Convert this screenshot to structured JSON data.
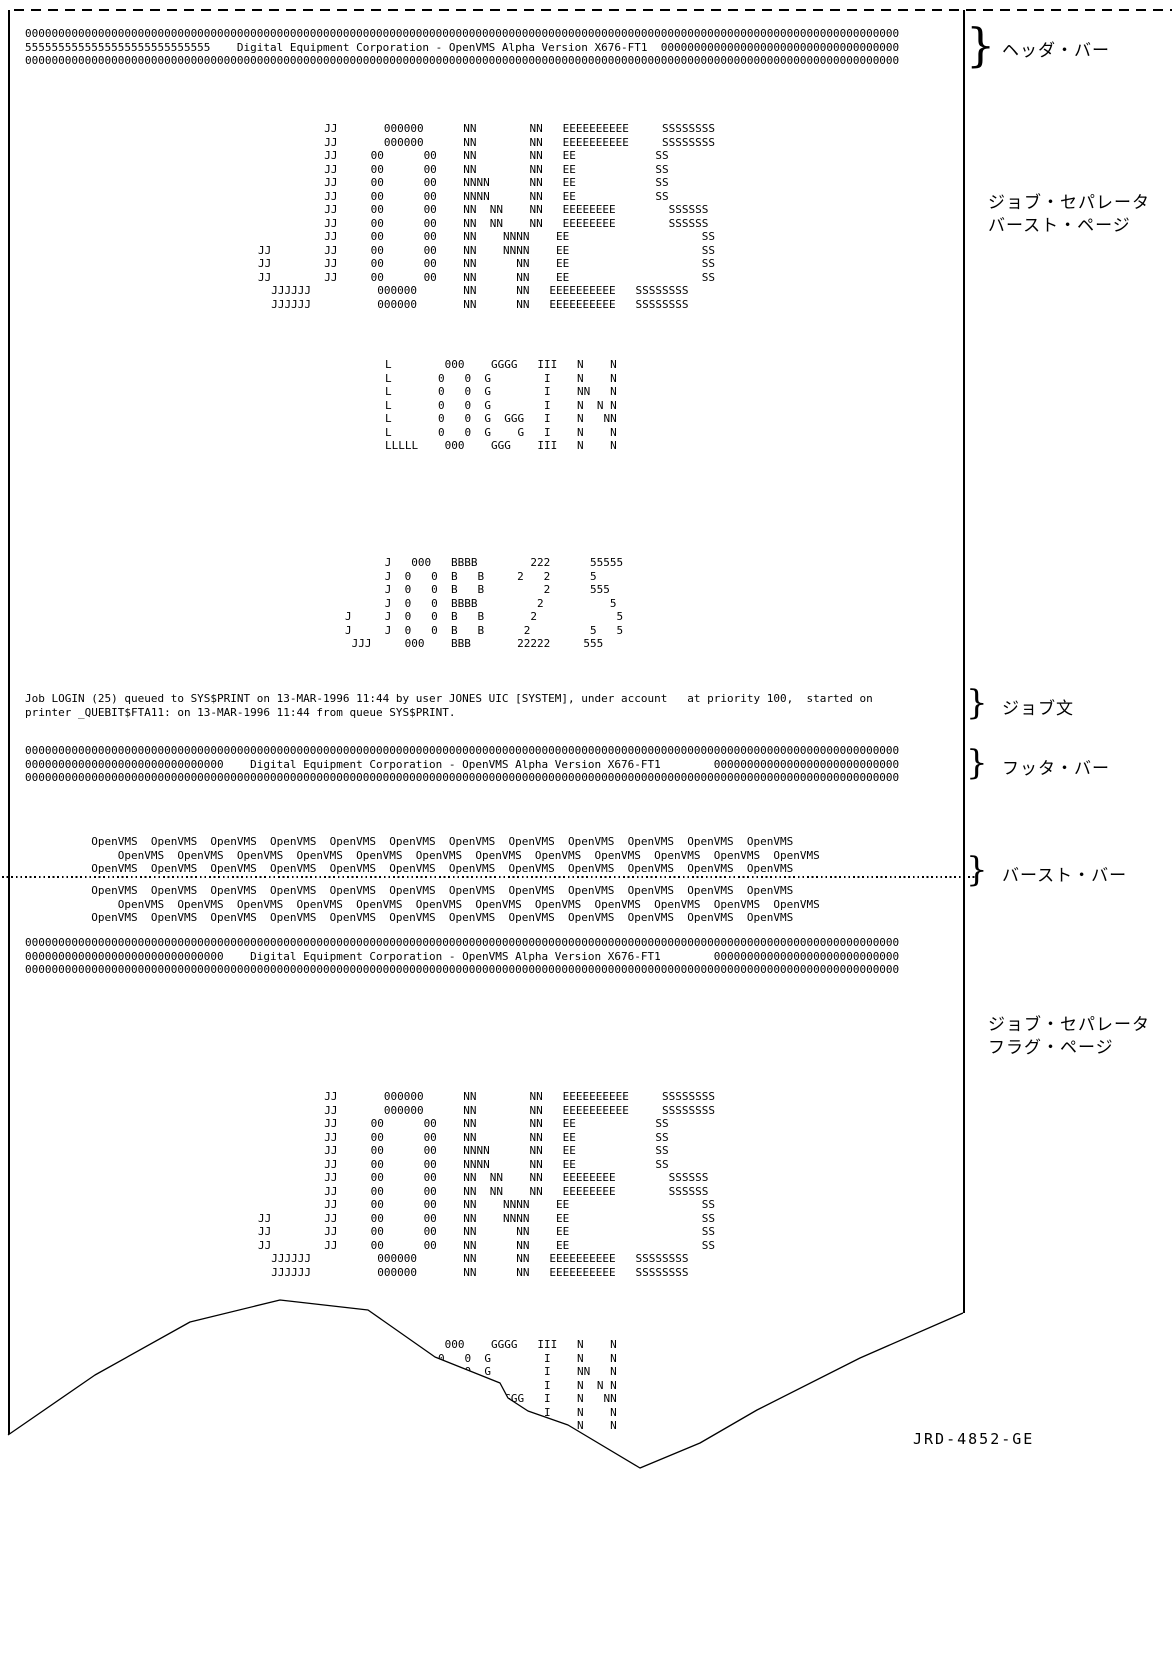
{
  "colors": {
    "ink": "#000000",
    "background": "#ffffff"
  },
  "bars": {
    "title": "Digital Equipment Corporation - OpenVMS Alpha Version X676-FT1",
    "header": {
      "lines": [
        "000000000000000000000000000000000000000000000000000000000000000000000000000000000000000000000000000000000000000000000000000000000000",
        "5555555555555555555555555555    Digital Equipment Corporation - OpenVMS Alpha Version X676-FT1  000000000000000000000000000000000000",
        "000000000000000000000000000000000000000000000000000000000000000000000000000000000000000000000000000000000000000000000000000000000000"
      ]
    },
    "footer": {
      "lines": [
        "000000000000000000000000000000000000000000000000000000000000000000000000000000000000000000000000000000000000000000000000000000000000",
        "000000000000000000000000000000    Digital Equipment Corporation - OpenVMS Alpha Version X676-FT1        0000000000000000000000000000",
        "000000000000000000000000000000000000000000000000000000000000000000000000000000000000000000000000000000000000000000000000000000000000"
      ]
    },
    "header2": {
      "lines": [
        "000000000000000000000000000000000000000000000000000000000000000000000000000000000000000000000000000000000000000000000000000000000000",
        "000000000000000000000000000000    Digital Equipment Corporation - OpenVMS Alpha Version X676-FT1        0000000000000000000000000000",
        "000000000000000000000000000000000000000000000000000000000000000000000000000000000000000000000000000000000000000000000000000000000000"
      ]
    }
  },
  "banners": {
    "jones": {
      "lines": [
        "          JJ       000000      NN        NN   EEEEEEEEEE     SSSSSSSS",
        "          JJ       000000      NN        NN   EEEEEEEEEE     SSSSSSSS",
        "          JJ     00      00    NN        NN   EE            SS",
        "          JJ     00      00    NN        NN   EE            SS",
        "          JJ     00      00    NNNN      NN   EE            SS",
        "          JJ     00      00    NNNN      NN   EE            SS",
        "          JJ     00      00    NN  NN    NN   EEEEEEEE        SSSSSS",
        "          JJ     00      00    NN  NN    NN   EEEEEEEE        SSSSSS",
        "          JJ     00      00    NN    NNNN    EE                    SS",
        "JJ        JJ     00      00    NN    NNNN    EE                    SS",
        "JJ        JJ     00      00    NN      NN    EE                    SS",
        "JJ        JJ     00      00    NN      NN    EE                    SS",
        "  JJJJJJ          000000       NN      NN   EEEEEEEEEE   SSSSSSSS",
        "  JJJJJJ          000000       NN      NN   EEEEEEEEEE   SSSSSSSS"
      ]
    },
    "login": {
      "lines": [
        "L        000    GGGG   III   N    N",
        "L       0   0  G        I    N    N",
        "L       0   0  G        I    NN   N",
        "L       0   0  G        I    N  N N",
        "L       0   0  G  GGG   I    N   NN",
        "L       0   0  G    G   I    N    N",
        "LLLLL    000    GGG    III   N    N"
      ]
    },
    "job25": {
      "lines": [
        "      J   000   BBBB        222      55555",
        "      J  0   0  B   B     2   2      5",
        "      J  0   0  B   B         2      555",
        "      J  0   0  BBBB         2          5",
        "J     J  0   0  B   B       2            5",
        "J     J  0   0  B   B      2         5   5",
        " JJJ     000    BBB       22222     555"
      ]
    }
  },
  "job_text": {
    "lines": [
      "Job LOGIN (25) queued to SYS$PRINT on 13-MAR-1996 11:44 by user JONES UIC [SYSTEM], under account   at priority 100,  started on",
      "printer _QUEBIT$FTA11: on 13-MAR-1996 11:44 from queue SYS$PRINT."
    ]
  },
  "openvms_rows": {
    "lines": [
      "          OpenVMS  OpenVMS  OpenVMS  OpenVMS  OpenVMS  OpenVMS  OpenVMS  OpenVMS  OpenVMS  OpenVMS  OpenVMS  OpenVMS",
      "              OpenVMS  OpenVMS  OpenVMS  OpenVMS  OpenVMS  OpenVMS  OpenVMS  OpenVMS  OpenVMS  OpenVMS  OpenVMS  OpenVMS",
      "          OpenVMS  OpenVMS  OpenVMS  OpenVMS  OpenVMS  OpenVMS  OpenVMS  OpenVMS  OpenVMS  OpenVMS  OpenVMS  OpenVMS"
    ]
  },
  "annotations": {
    "brace": "}",
    "header_bar": "ヘッダ・バー",
    "job_separator_burst": [
      "ジョブ・セパレータ",
      "バースト・ページ"
    ],
    "job_statement": "ジョブ文",
    "footer_bar": "フッタ・バー",
    "burst_bar": "バースト・バー",
    "job_separator_flag": [
      "ジョブ・セパレータ",
      "フラグ・ページ"
    ]
  },
  "figure": {
    "id_label": "JRD-4852-GE"
  }
}
